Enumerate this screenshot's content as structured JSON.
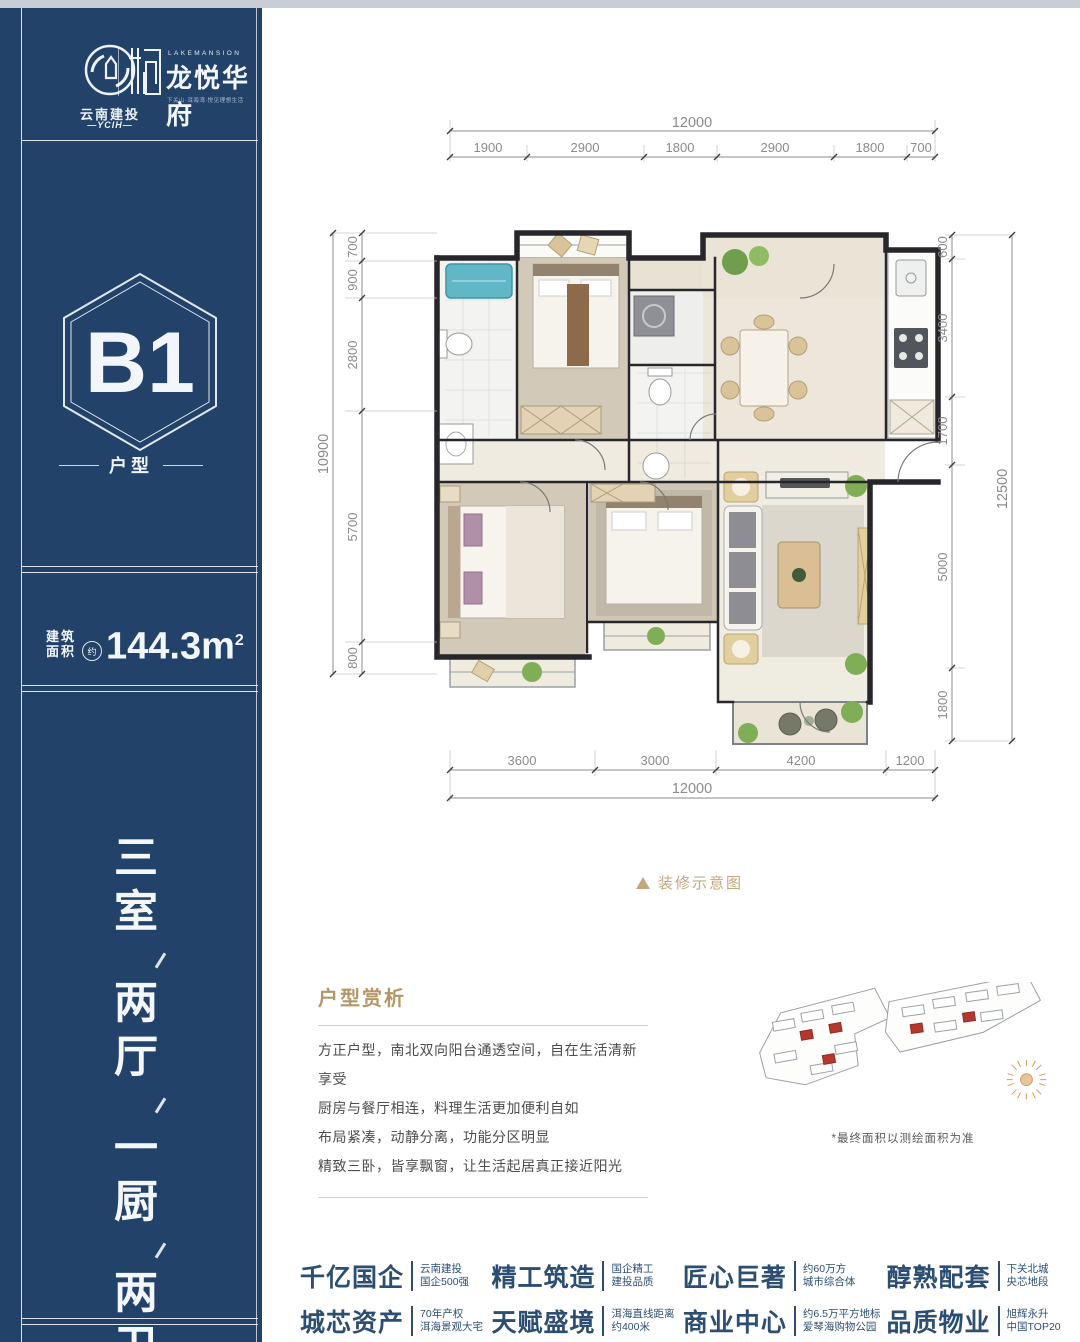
{
  "sidebar": {
    "logos": {
      "developer_cn": "云南建投",
      "developer_en": "—YCIH—",
      "project_en": "LAKEMANSION",
      "project_cn": "龙悦华府",
      "project_tagline": "下关山·洱海湾·悦见理想生活"
    },
    "unit_badge": {
      "code": "B1",
      "type_label": "户型"
    },
    "area": {
      "label1": "建筑",
      "label2": "面积",
      "approx": "约",
      "value": "144.3",
      "unit": "m",
      "sup": "2"
    },
    "rooms_vertical": {
      "groups": [
        "三室",
        "两厅",
        "一厨",
        "两卫"
      ]
    }
  },
  "floorplan": {
    "caption": "装修示意图",
    "dims_top": {
      "total": "12000",
      "segments": [
        "1900",
        "2900",
        "1800",
        "2900",
        "1800",
        "700"
      ]
    },
    "dims_bottom": {
      "total": "12000",
      "segments": [
        "3600",
        "3000",
        "4200",
        "1200"
      ]
    },
    "dims_left": {
      "total": "10900",
      "segments": [
        "700",
        "900",
        "2800",
        "5700",
        "800"
      ]
    },
    "dims_right": {
      "total": "12500",
      "segments": [
        "600",
        "3400",
        "1700",
        "5000",
        "1800"
      ]
    }
  },
  "analysis": {
    "title": "户型赏析",
    "lines": [
      "方正户型，南北双向阳台通透空间，自在生活清新享受",
      "厨房与餐厅相连，料理生活更加便利自如",
      "布局紧凑，动静分离，功能分区明显",
      "精致三卧，皆享飘窗，让生活起居真正接近阳光"
    ]
  },
  "siteplan": {
    "note": "*最终面积以测绘面积为准"
  },
  "features": [
    {
      "title": "千亿国企",
      "line1": "云南建投",
      "line2": "国企500强"
    },
    {
      "title": "城芯资产",
      "line1": "70年产权",
      "line2": "洱海景观大宅"
    },
    {
      "title": "精工筑造",
      "line1": "国企精工",
      "line2": "建投品质"
    },
    {
      "title": "天赋盛境",
      "line1": "洱海直线距离",
      "line2": "约400米"
    },
    {
      "title": "匠心巨著",
      "line1": "约60万方",
      "line2": "城市综合体"
    },
    {
      "title": "商业中心",
      "line1": "约6.5万平方地标",
      "line2": "爱琴海购物公园"
    },
    {
      "title": "醇熟配套",
      "line1": "下关北城",
      "line2": "央芯地段"
    },
    {
      "title": "品质物业",
      "line1": "旭辉永升",
      "line2": "中国TOP20"
    }
  ],
  "colors": {
    "sidebar_navy": "#23426a",
    "accent_gold": "#b49668",
    "caption_tan": "#c2a87e",
    "feature_navy": "#2d4e73",
    "tub_teal": "#62b7c6",
    "plant_green": "#7fae57",
    "siteplan_red": "#b5382e"
  }
}
